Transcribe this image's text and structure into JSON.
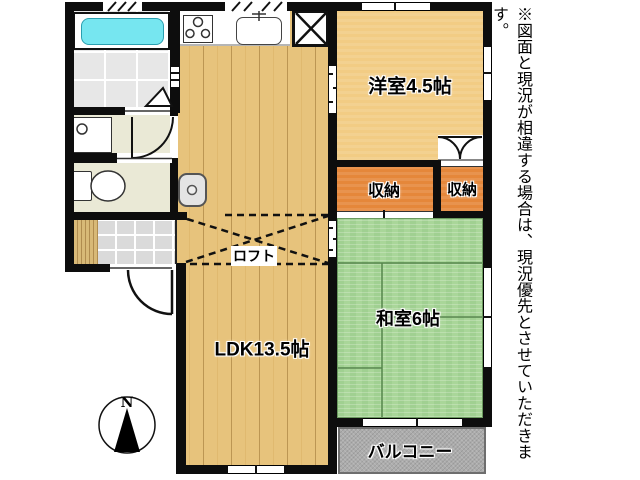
{
  "floorplan": {
    "rooms": {
      "western": {
        "label": "洋室4.5帖"
      },
      "storage_left": {
        "label": "収納"
      },
      "storage_right": {
        "label": "収納"
      },
      "japanese": {
        "label": "和室6帖"
      },
      "ldk": {
        "label": "LDK13.5帖"
      },
      "loft": {
        "label": "ロフト"
      },
      "balcony": {
        "label": "バルコニー"
      }
    },
    "compass": {
      "north_label": "N"
    },
    "disclaimer": "※図面と現況が相違する場合は、現況優先とさせていただきます。",
    "fixtures": [
      "bathtub",
      "bathroom-tiled-floor",
      "washbasin",
      "toilet",
      "genkan-step",
      "genkan-tile",
      "kitchen-stove",
      "kitchen-sink",
      "refrigerator-space",
      "washing-machine-pan",
      "closet-double-door",
      "sliding-door-marks",
      "loft-dashed-outline",
      "entrance-door",
      "compass"
    ],
    "colors": {
      "wall": "#0d0d0d",
      "wood_floor": "#e7c37c",
      "western_room": "#f2cc84",
      "storage": "#e5873a",
      "tatami": "#a9d699",
      "balcony": "#acacac",
      "bathtub_water": "#76e6f0",
      "bathroom_tile": "#e7e7e7",
      "utility_floor": "#eae9d6",
      "genkan_tile": "#dadada",
      "step_wood": "#d8b977"
    }
  }
}
